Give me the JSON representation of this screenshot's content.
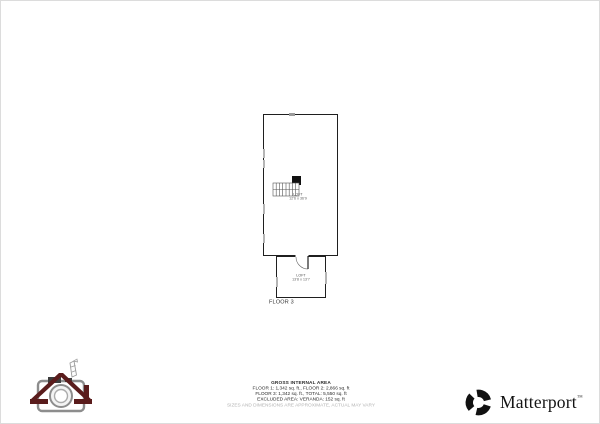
{
  "plan": {
    "floor_label": "FLOOR 3",
    "main_room": {
      "name": "LOFT",
      "dims": "12'6 x 36'9"
    },
    "entry_room": {
      "name": "LOFT",
      "dims": "13'8 x 13'7"
    }
  },
  "summary": {
    "title": "GROSS INTERNAL AREA",
    "lines": [
      "FLOOR 1: 1,342 sq. ft., FLOOR 2: 2,866 sq. ft",
      "FLOOR 3: 1,342 sq. ft., TOTAL: 5,550 sq. ft",
      "EXCLUDED AREA: VERANDA: 152 sq. ft"
    ],
    "disclaimer": "SIZES AND DIMENSIONS ARE APPROXIMATE, ACTUAL MAY VARY"
  },
  "branding": {
    "wordmark": "Matterport",
    "trademark": "™"
  },
  "colors": {
    "wall": "#1f1f1f",
    "window": "#b5b5b5",
    "text": "#2a2a2a",
    "disclaimer_gray": "#b3b3b3",
    "roof_maroon": "#5a1c1c",
    "camera_gray": "#8d8d8d"
  }
}
